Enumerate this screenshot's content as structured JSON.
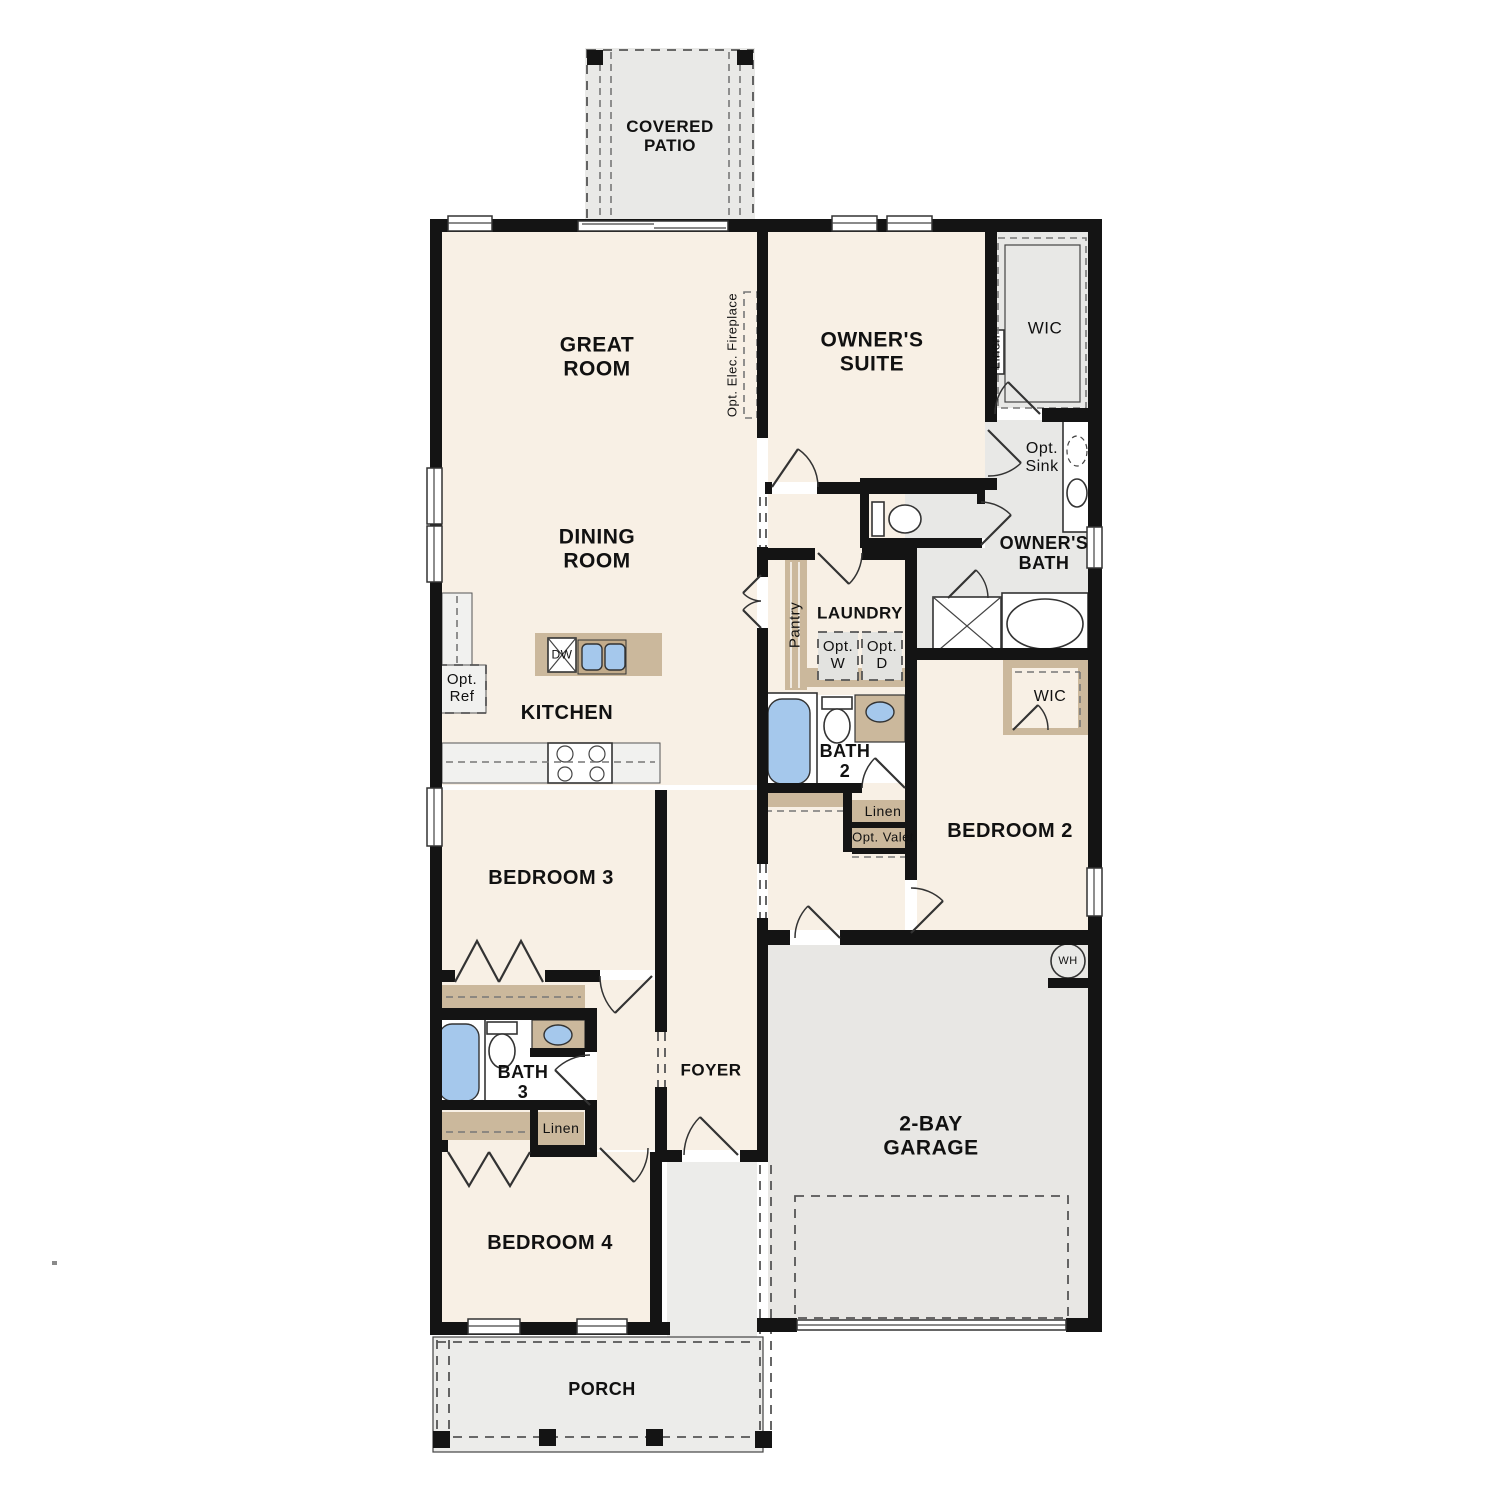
{
  "title": "Single-story house floor plan",
  "colors": {
    "cream": "#f8f0e5",
    "roomgray": "#e8e8e6",
    "garage": "#e8e7e4",
    "porch": "#ececea",
    "patio": "#e9e9e7",
    "tan": "#cbb89c",
    "tandark": "#c2ab8a",
    "blue": "#a5c8ec",
    "wall": "#141414",
    "counter": "#f1f1ef",
    "dash": "#777",
    "line": "#333",
    "white": "#ffffff"
  },
  "labels": {
    "covered_patio": "COVERED\nPATIO",
    "great_room": "GREAT\nROOM",
    "dining_room": "DINING\nROOM",
    "owners_suite": "OWNER'S\nSUITE",
    "wic_owner": "WIC",
    "linen_owner": "Linen",
    "opt_sink": "Opt.\nSink",
    "owners_bath": "OWNER'S\nBATH",
    "opt_elec_fireplace": "Opt. Elec. Fireplace",
    "pantry": "Pantry",
    "laundry": "LAUNDRY",
    "opt_w": "Opt.\nW",
    "opt_d": "Opt.\nD",
    "kitchen": "KITCHEN",
    "opt_ref": "Opt.\nRef",
    "dw": "DW",
    "bath_2": "BATH\n2",
    "linen_hall": "Linen",
    "opt_valet": "Opt. Valet",
    "wic_bedroom2": "WIC",
    "bedroom_2": "BEDROOM 2",
    "bedroom_3": "BEDROOM 3",
    "bath_3": "BATH\n3",
    "linen_bath3": "Linen",
    "foyer": "FOYER",
    "bedroom_4": "BEDROOM 4",
    "garage": "2-BAY\nGARAGE",
    "water_heater": "WH",
    "porch": "PORCH"
  }
}
